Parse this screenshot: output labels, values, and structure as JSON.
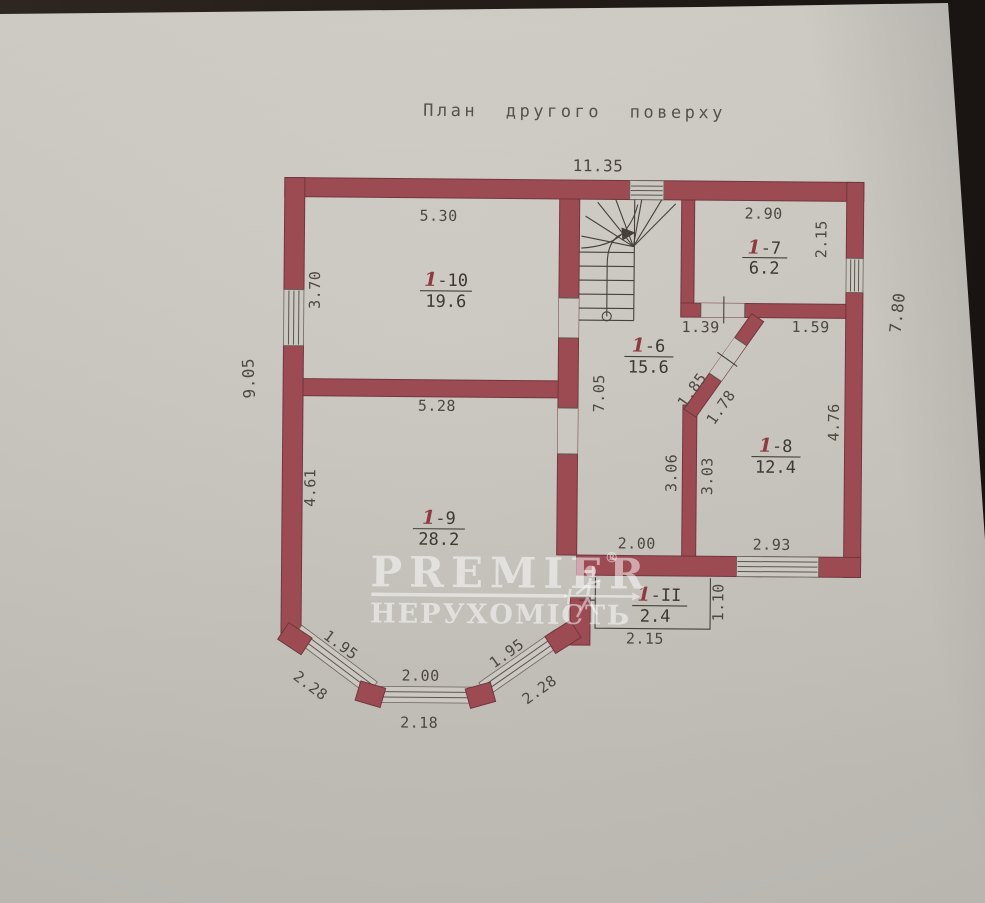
{
  "title": "План другого поверху",
  "watermark": {
    "brand": "PREMIER",
    "registered": "®",
    "subtitle": "НЕРУХОМІСТЬ"
  },
  "colors": {
    "wall": "#9c4b53",
    "paper": "#c8c5be",
    "handwritten_mark": "#8e3a40",
    "drawing_line": "#45413a"
  },
  "dimensions": {
    "overall_top": "11.35",
    "overall_left": "9.05",
    "overall_right": "7.80",
    "room10_width": "5.30",
    "room10_height": "3.70",
    "room9_width": "5.28",
    "room9_height": "4.61",
    "room7_width": "2.90",
    "room7_height": "2.15",
    "room8_top": "1.59",
    "room8_height": "4.76",
    "room8_left_height": "3.03",
    "room8_width": "2.93",
    "hall_height": "7.05",
    "hall_right_height": "3.06",
    "hall_width": "2.00",
    "door_to_room7": "1.39",
    "diagonal_left": "1.85",
    "diagonal_right": "1.78",
    "balcony_width": "2.15",
    "balcony_height": "1.10",
    "bay_left_inner": "1.95",
    "bay_left_outer": "2.28",
    "bay_center_inner": "2.00",
    "bay_center_outer": "2.18",
    "bay_right_inner": "1.95",
    "bay_right_outer": "2.28"
  },
  "rooms": {
    "room10": {
      "prefix": "1",
      "number": "-10",
      "area": "19.6"
    },
    "room7": {
      "prefix": "1",
      "number": "-7",
      "area": "6.2"
    },
    "room6": {
      "prefix": "1",
      "number": "-6",
      "area": "15.6"
    },
    "room9": {
      "prefix": "1",
      "number": "-9",
      "area": "28.2"
    },
    "room8": {
      "prefix": "1",
      "number": "-8",
      "area": "12.4"
    },
    "room11": {
      "prefix": "1",
      "number": "-II",
      "area": "2.4"
    }
  }
}
